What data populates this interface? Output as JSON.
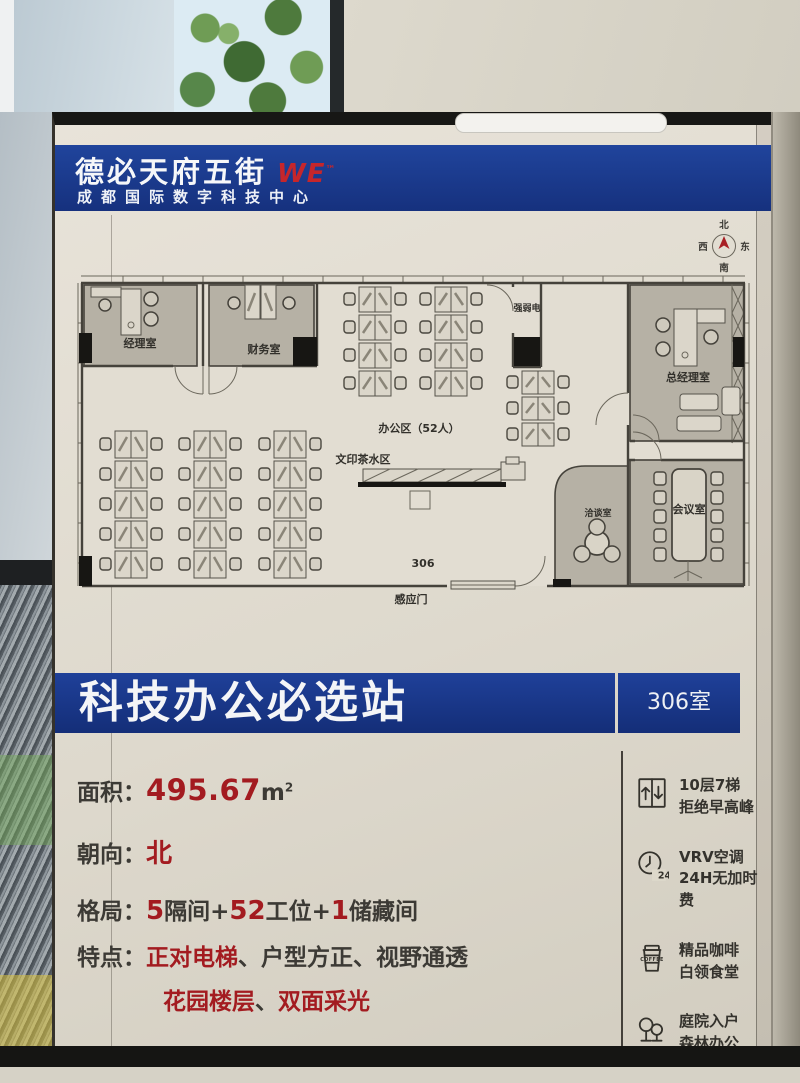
{
  "header": {
    "brand": "德必天府五街",
    "brand_mark": "WE",
    "brand_mark_sup": "™",
    "subtitle": "成都国际数字科技中心"
  },
  "compass": {
    "north": "北",
    "east": "东",
    "south": "南",
    "west": "西"
  },
  "floorplan": {
    "manager_office": "经理室",
    "finance_office": "财务室",
    "electrical_room": "强弱电",
    "open_office": "办公区（52人）",
    "print_tea_area": "文印茶水区",
    "gm_office": "总经理室",
    "meeting_room": "会议室",
    "negotiation_room": "洽谈室",
    "room_number": "306",
    "sensor_door": "感应门"
  },
  "banner": {
    "title": "科技办公必选站",
    "room_badge": "306室"
  },
  "details": {
    "area_label": "面积：",
    "area_value": "495.67",
    "area_unit": "m",
    "area_unit_sup": "2",
    "facing_label": "朝向：",
    "facing_value": "北",
    "layout_label": "格局：",
    "layout_num1": "5",
    "layout_text1": "隔间+",
    "layout_num2": "52",
    "layout_text2": "工位+",
    "layout_num3": "1",
    "layout_text3": "储藏间",
    "features_label": "特点：",
    "feature1_red": "正对电梯",
    "feature1_rest": "、户型方正、视野通透",
    "feature2_red1": "花园楼层",
    "feature2_sep": "、",
    "feature2_red2": "双面采光"
  },
  "amenities": [
    {
      "icon": "elevator-icon",
      "line1": "10层7梯",
      "line2": "拒绝早高峰"
    },
    {
      "icon": "clock-24-icon",
      "line1": "VRV空调",
      "line2": "24H无加时费",
      "badge": "24"
    },
    {
      "icon": "coffee-icon",
      "line1": "精品咖啡",
      "line2": "白领食堂",
      "badge": "COFFEE"
    },
    {
      "icon": "trees-icon",
      "line1": "庭院入户",
      "line2": "森林办公"
    }
  ]
}
